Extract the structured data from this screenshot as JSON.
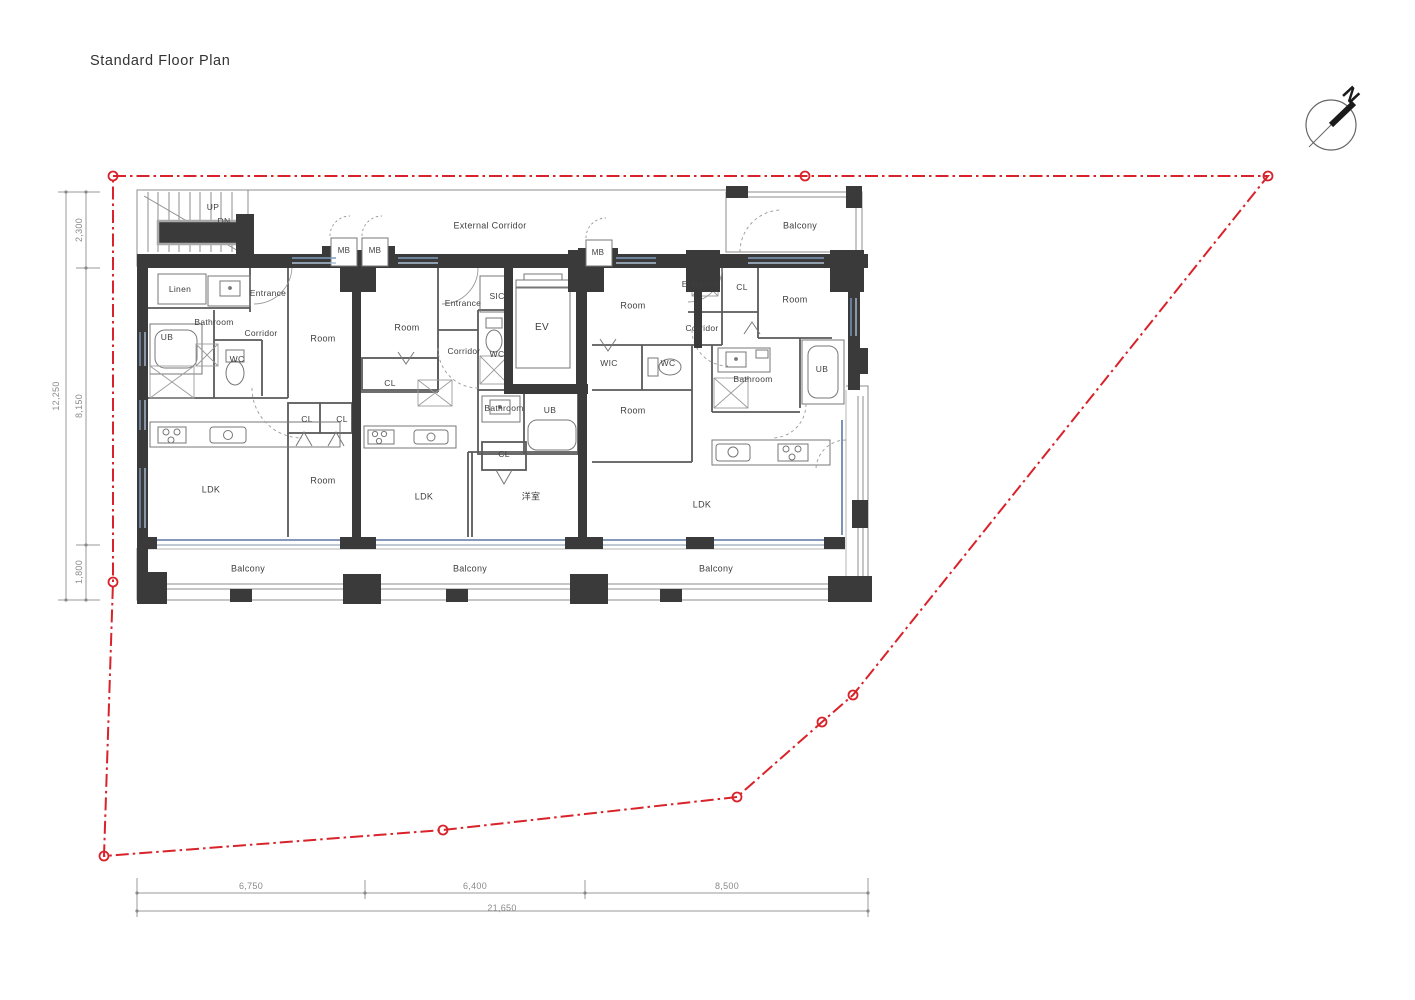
{
  "title": "Standard Floor Plan",
  "compass": {
    "label": "N"
  },
  "colors": {
    "boundary_red": "#d8232a",
    "wall_black": "#3a3a3a",
    "window_blue": "#7e9cc0",
    "window_navy": "#5b76a3",
    "line_gray": "#8a8a8a"
  },
  "site_boundary": {
    "vertices": [
      [
        113,
        176
      ],
      [
        805,
        176
      ],
      [
        1268,
        176
      ],
      [
        853,
        695
      ],
      [
        822,
        722
      ],
      [
        737,
        797
      ],
      [
        443,
        830
      ],
      [
        104,
        856
      ],
      [
        113,
        582
      ]
    ]
  },
  "dimensions": {
    "left": {
      "total": "12,250",
      "segments": [
        "2,300",
        "8,150",
        "1,800"
      ]
    },
    "bottom": {
      "total": "21,650",
      "segments": [
        "6,750",
        "6,400",
        "8,500"
      ]
    }
  },
  "plan_labels": [
    {
      "t": "UP",
      "x": 213,
      "y": 207,
      "s": 8.5,
      "n": "stairs-up-label"
    },
    {
      "t": "DN",
      "x": 224,
      "y": 221,
      "s": 8.5,
      "n": "stairs-dn-label"
    },
    {
      "t": "External Corridor",
      "x": 490,
      "y": 226,
      "n": "external-corridor-label"
    },
    {
      "t": "Balcony",
      "x": 800,
      "y": 226,
      "n": "balcony-north-label"
    },
    {
      "t": "MB",
      "x": 344,
      "y": 251,
      "s": 8,
      "n": "mailbox-label-1"
    },
    {
      "t": "MB",
      "x": 375,
      "y": 251,
      "s": 8,
      "n": "mailbox-label-2"
    },
    {
      "t": "MB",
      "x": 598,
      "y": 253,
      "s": 8,
      "n": "mailbox-label-3"
    },
    {
      "t": "Linen",
      "x": 180,
      "y": 289,
      "s": 8.5,
      "n": "linen-label"
    },
    {
      "t": "Entrance",
      "x": 268,
      "y": 293,
      "s": 8.5,
      "n": "entrance-a-label"
    },
    {
      "t": "Bathroom",
      "x": 214,
      "y": 322,
      "s": 8.5,
      "n": "bathroom-a-label"
    },
    {
      "t": "UB",
      "x": 167,
      "y": 337,
      "s": 8.5,
      "n": "ub-a-label"
    },
    {
      "t": "Corridor",
      "x": 261,
      "y": 333,
      "s": 8.5,
      "n": "corridor-a-label"
    },
    {
      "t": "WC",
      "x": 237,
      "y": 359,
      "s": 8.5,
      "n": "wc-a-label"
    },
    {
      "t": "Room",
      "x": 323,
      "y": 339,
      "n": "room-a1-label"
    },
    {
      "t": "CL",
      "x": 307,
      "y": 419,
      "s": 8.5,
      "n": "cl-a1-label"
    },
    {
      "t": "CL",
      "x": 342,
      "y": 419,
      "s": 8.5,
      "n": "cl-a2-label"
    },
    {
      "t": "Room",
      "x": 323,
      "y": 481,
      "n": "room-a2-label"
    },
    {
      "t": "LDK",
      "x": 211,
      "y": 490,
      "n": "ldk-a-label"
    },
    {
      "t": "Room",
      "x": 407,
      "y": 328,
      "n": "room-b1-label"
    },
    {
      "t": "Entrance",
      "x": 463,
      "y": 303,
      "s": 8.5,
      "n": "entrance-b-label"
    },
    {
      "t": "SIC",
      "x": 497,
      "y": 296,
      "s": 8.5,
      "n": "sic-label"
    },
    {
      "t": "Corridor",
      "x": 464,
      "y": 351,
      "s": 8.5,
      "n": "corridor-b-label"
    },
    {
      "t": "WC",
      "x": 497,
      "y": 354,
      "s": 8.5,
      "n": "wc-b-label"
    },
    {
      "t": "EV",
      "x": 542,
      "y": 328,
      "s": 10,
      "n": "elevator-label"
    },
    {
      "t": "CL",
      "x": 390,
      "y": 383,
      "s": 8.5,
      "n": "cl-b1-label"
    },
    {
      "t": "Bathroom",
      "x": 504,
      "y": 408,
      "s": 8.5,
      "n": "bathroom-b-label"
    },
    {
      "t": "UB",
      "x": 550,
      "y": 410,
      "s": 8.5,
      "n": "ub-b-label"
    },
    {
      "t": "CL",
      "x": 504,
      "y": 454,
      "s": 8.5,
      "n": "cl-b2-label"
    },
    {
      "t": "LDK",
      "x": 424,
      "y": 497,
      "n": "ldk-b-label"
    },
    {
      "t": "洋室",
      "x": 531,
      "y": 497,
      "n": "japanese-room-label"
    },
    {
      "t": "Entrance",
      "x": 700,
      "y": 284,
      "s": 8.5,
      "n": "entrance-c-label"
    },
    {
      "t": "CL",
      "x": 742,
      "y": 287,
      "s": 8.5,
      "n": "cl-c-label"
    },
    {
      "t": "Room",
      "x": 795,
      "y": 300,
      "n": "room-c2-label"
    },
    {
      "t": "Room",
      "x": 633,
      "y": 306,
      "n": "room-c1-label"
    },
    {
      "t": "Corridor",
      "x": 702,
      "y": 328,
      "s": 8.5,
      "n": "corridor-c-label"
    },
    {
      "t": "WIC",
      "x": 609,
      "y": 363,
      "s": 8.5,
      "n": "wic-label"
    },
    {
      "t": "WC",
      "x": 668,
      "y": 363,
      "s": 8.5,
      "n": "wc-c-label"
    },
    {
      "t": "Bathroom",
      "x": 753,
      "y": 379,
      "s": 8.5,
      "n": "bathroom-c-label"
    },
    {
      "t": "UB",
      "x": 822,
      "y": 369,
      "s": 8.5,
      "n": "ub-c-label"
    },
    {
      "t": "Room",
      "x": 633,
      "y": 411,
      "n": "room-c3-label"
    },
    {
      "t": "LDK",
      "x": 702,
      "y": 505,
      "n": "ldk-c-label"
    },
    {
      "t": "Balcony",
      "x": 248,
      "y": 569,
      "n": "balcony-south-1-label"
    },
    {
      "t": "Balcony",
      "x": 470,
      "y": 569,
      "n": "balcony-south-2-label"
    },
    {
      "t": "Balcony",
      "x": 716,
      "y": 569,
      "n": "balcony-south-3-label"
    }
  ]
}
